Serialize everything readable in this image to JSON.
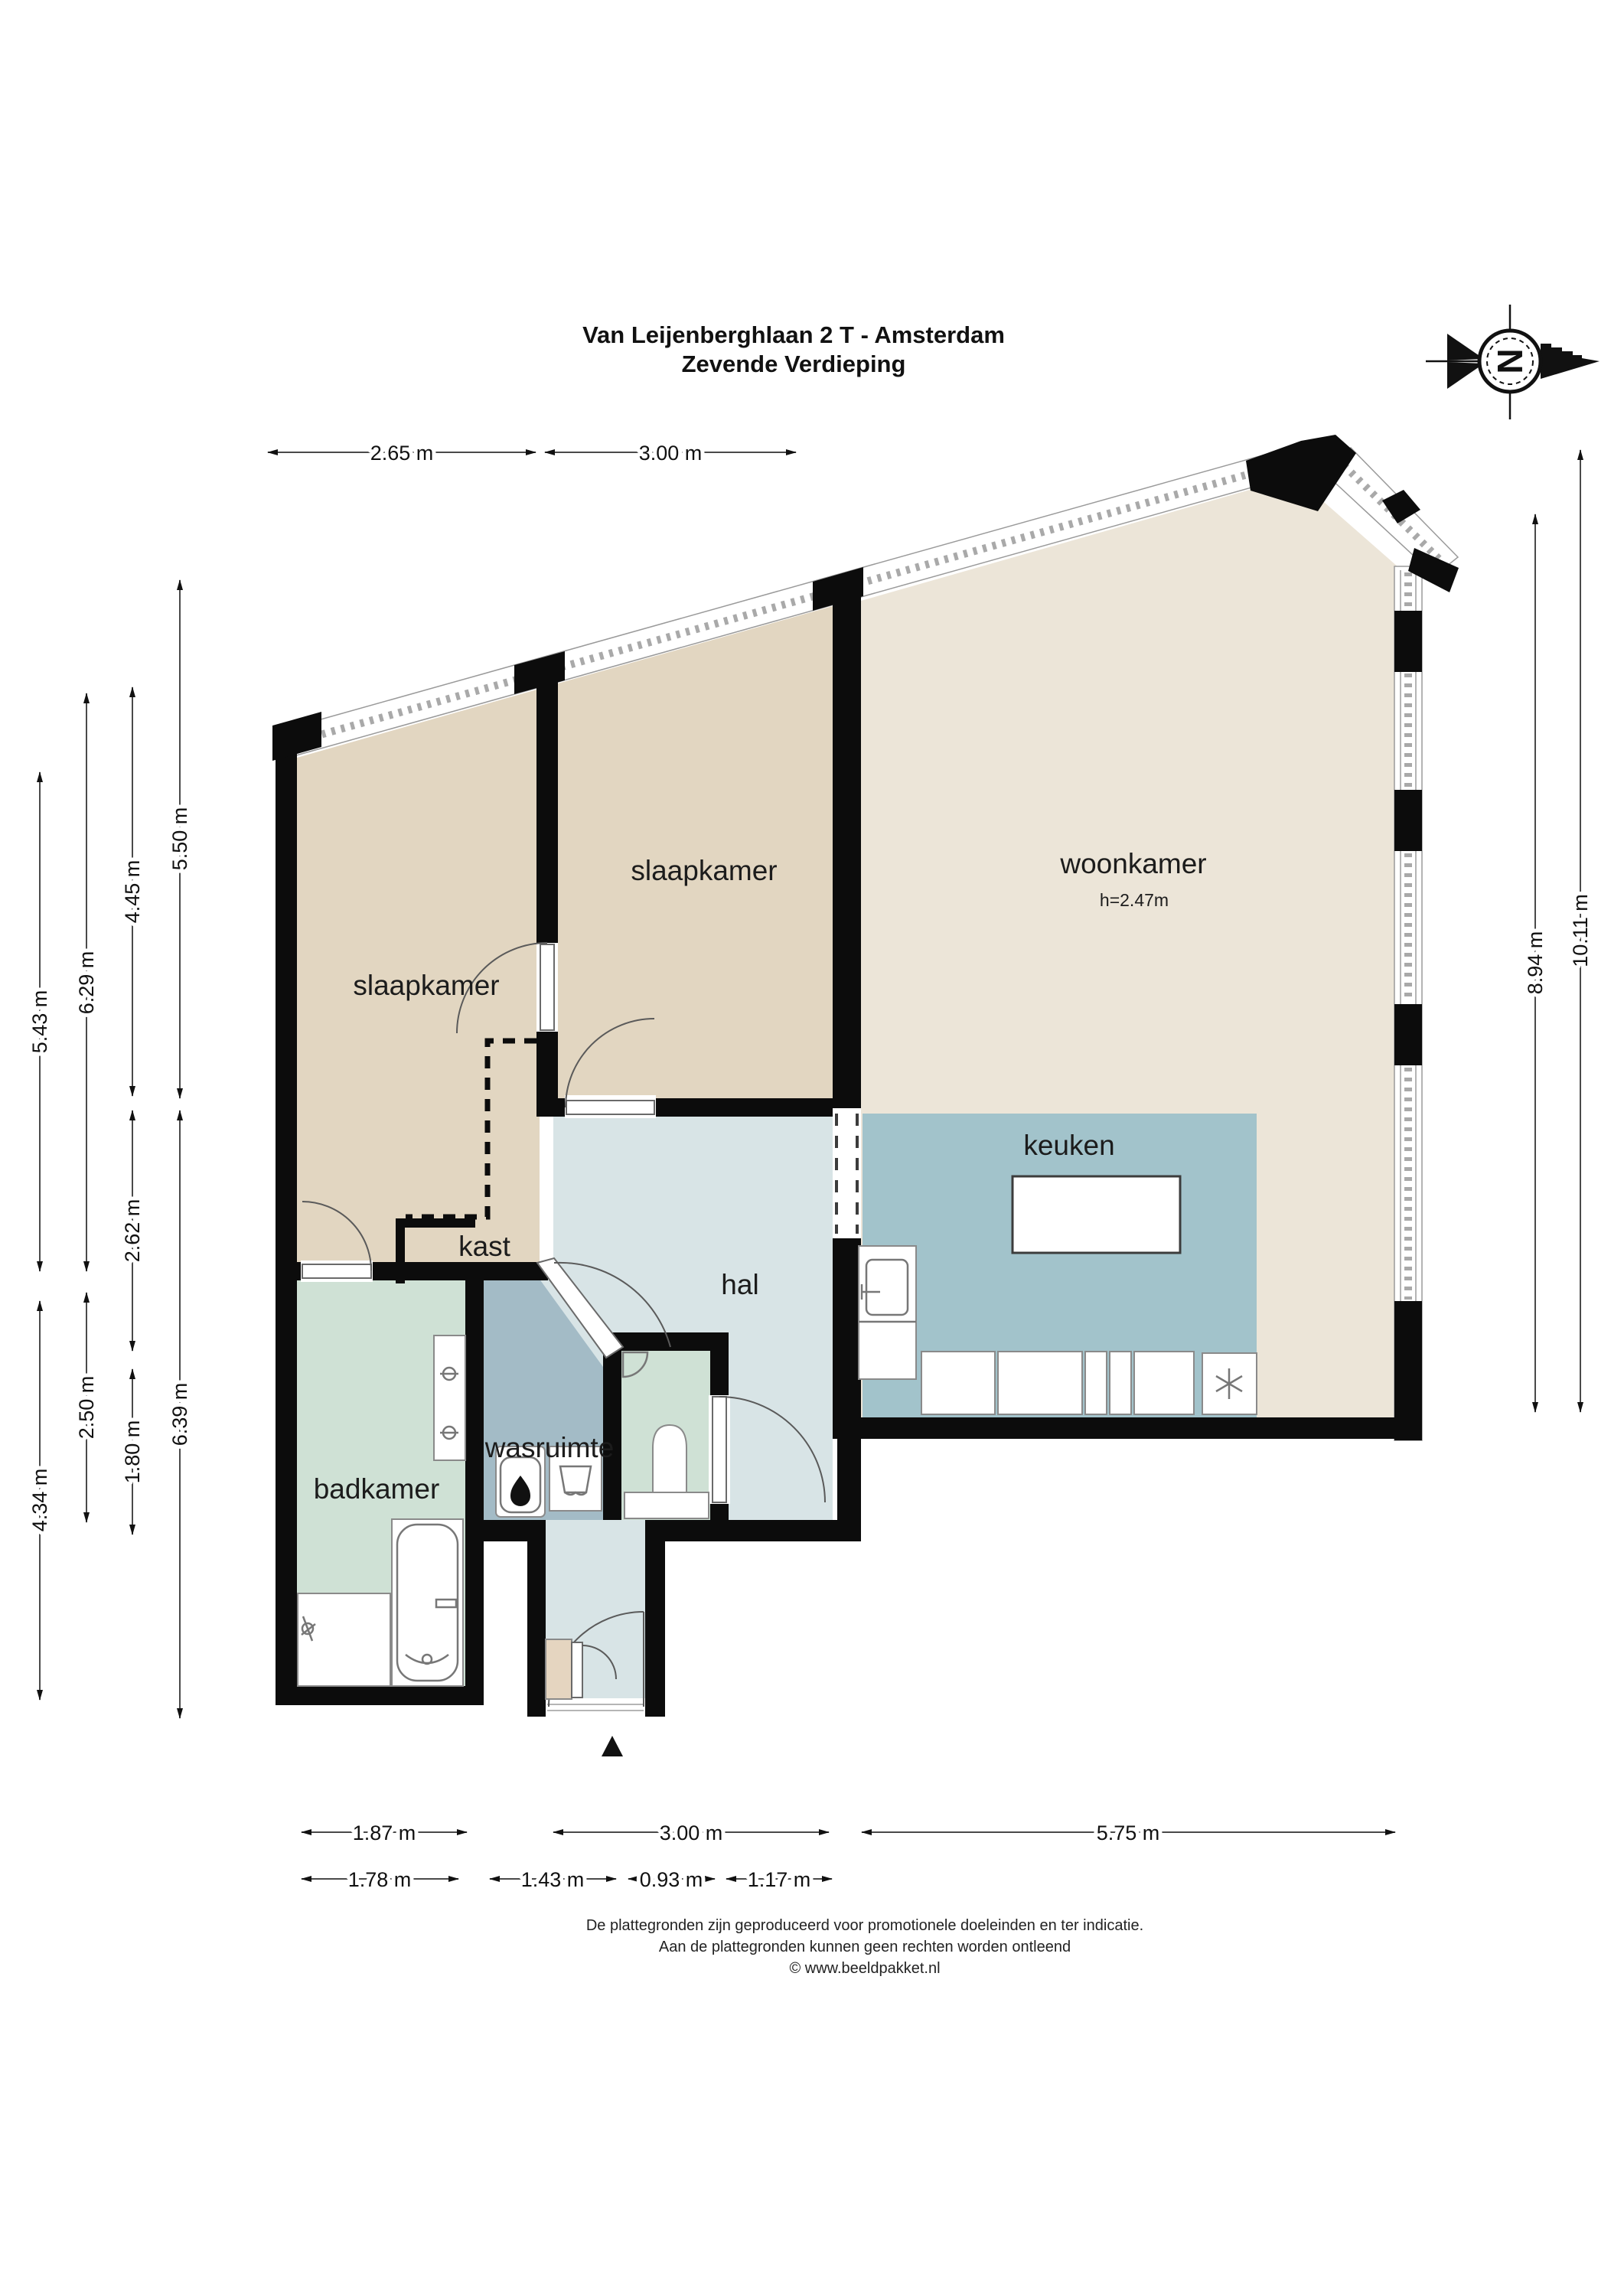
{
  "title": {
    "line1": "Van Leijenberghlaan 2 T - Amsterdam",
    "line2": "Zevende Verdieping"
  },
  "compass": {
    "letter": "N"
  },
  "rooms": {
    "slaapkamer_left": "slaapkamer",
    "slaapkamer_mid": "slaapkamer",
    "woonkamer": "woonkamer",
    "woonkamer_ceiling_height": "h=2.47m",
    "keuken": "keuken",
    "hal": "hal",
    "kast": "kast",
    "wasruimte": "wasruimte",
    "badkamer": "badkamer"
  },
  "dimensions": {
    "top": [
      "2.65 m",
      "3.00 m"
    ],
    "left_col1": [
      "5.43 m",
      "4.34 m"
    ],
    "left_col2": [
      "6.29 m",
      "2.50 m"
    ],
    "left_col3": [
      "4.45 m",
      "2.62 m",
      "1.80 m"
    ],
    "left_col4": [
      "5.50 m",
      "6.39 m"
    ],
    "right": [
      "8.94 m",
      "10.11 m"
    ],
    "bottom_row1": [
      "1.87 m",
      "3.00 m",
      "5.75 m"
    ],
    "bottom_row2": [
      "1.78 m",
      "1.43 m",
      "0.93 m",
      "1.17 m"
    ]
  },
  "footer": {
    "line1": "De plattegronden zijn geproduceerd voor promotionele doeleinden en ter indicatie.",
    "line2": "Aan de plattegronden kunnen geen rechten worden ontleend",
    "line3": "© www.beeldpakket.nl"
  },
  "colors": {
    "wall": "#0c0c0c",
    "bedroom": "#e2d6c1",
    "living": "#ece5d8",
    "kitchen": "#a2c3cb",
    "hall": "#d8e4e6",
    "laundry": "#a3bbc6",
    "bath": "#cfe1d5",
    "cabinet": "#e5d5c0"
  }
}
